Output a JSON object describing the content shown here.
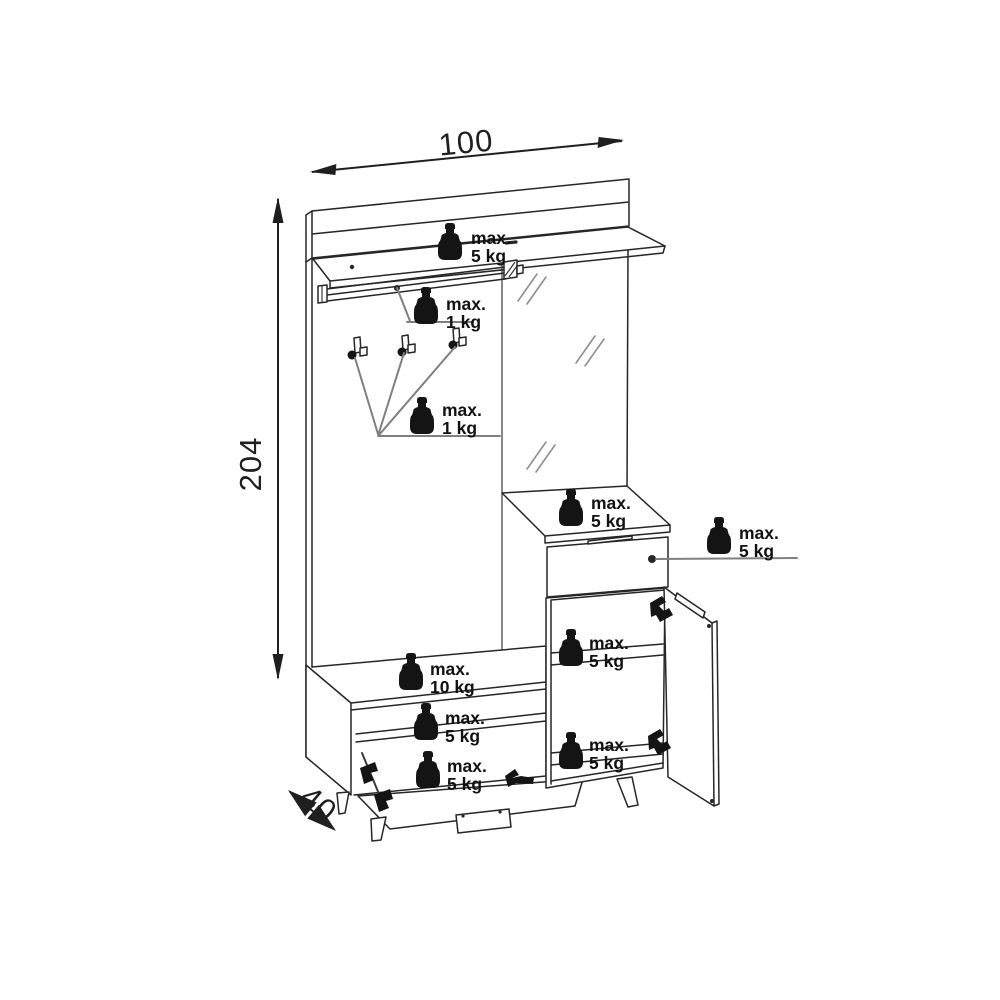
{
  "dimensions": {
    "width": "100",
    "height": "204",
    "depth": "40"
  },
  "load_labels": [
    {
      "id": "top-shelf",
      "line1": "max.",
      "line2": "5 kg"
    },
    {
      "id": "coat-rail",
      "line1": "max.",
      "line2": "1 kg"
    },
    {
      "id": "hooks",
      "line1": "max.",
      "line2": "1 kg"
    },
    {
      "id": "cabinet-top",
      "line1": "max.",
      "line2": "5 kg"
    },
    {
      "id": "drawer",
      "line1": "max.",
      "line2": "5 kg"
    },
    {
      "id": "cabinet-middle-shelf",
      "line1": "max.",
      "line2": "5 kg"
    },
    {
      "id": "cabinet-bottom-shelf",
      "line1": "max.",
      "line2": "5 kg"
    },
    {
      "id": "bench-top",
      "line1": "max.",
      "line2": "10 kg"
    },
    {
      "id": "bench-shelf",
      "line1": "max.",
      "line2": "5 kg"
    },
    {
      "id": "bench-flap",
      "line1": "max.",
      "line2": "5 kg"
    }
  ],
  "colors": {
    "line": "#262626",
    "leader": "#7f7f7f",
    "text": "#111111",
    "background": "#ffffff"
  }
}
